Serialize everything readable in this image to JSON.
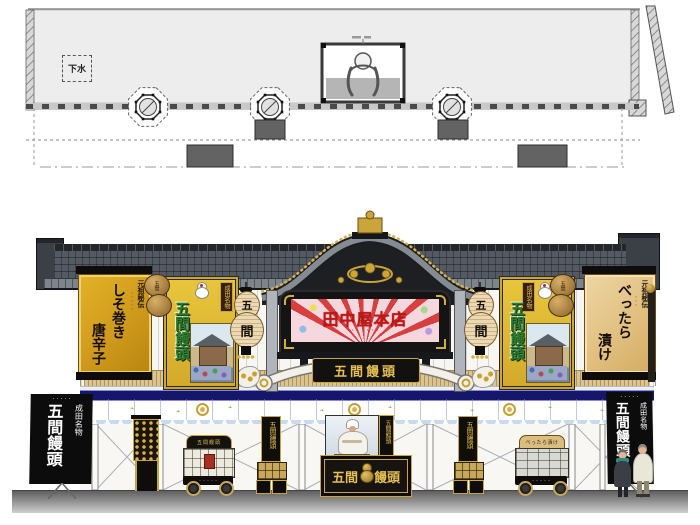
{
  "plan": {
    "drain_label": "下水"
  },
  "facade": {
    "name_sign": {
      "text": "田中屋本店",
      "subtext": "・・・・・・"
    },
    "arch_sign": {
      "text": "五間饅頭"
    },
    "left_banner": {
      "header": "元祖秘伝",
      "sub": "・・・・・",
      "line1": "しそ巻き",
      "line2": "唐辛子"
    },
    "right_banner": {
      "header": "元祖秘伝",
      "sub": "・・・",
      "line1": "べったら",
      "line2": "漬け"
    },
    "poster": {
      "seal": "成田名物",
      "title": "五間饅頭"
    },
    "gourd": {
      "char1": "五",
      "char2": "間"
    },
    "medallion": {
      "text": "五間"
    }
  },
  "street": {
    "nobori": {
      "top": "・・・・・",
      "small": "成田名物",
      "large": "五間饅頭"
    },
    "stand_sign": "五間饅頭",
    "craft_sign": "五間饅頭",
    "center_sign": {
      "left": "五間",
      "right": "饅頭"
    },
    "left_cart": {
      "top": "五間饅頭",
      "base": "・・・・・"
    },
    "right_cart": {
      "top": "べったら漬け",
      "base": "・・・・・"
    }
  }
}
